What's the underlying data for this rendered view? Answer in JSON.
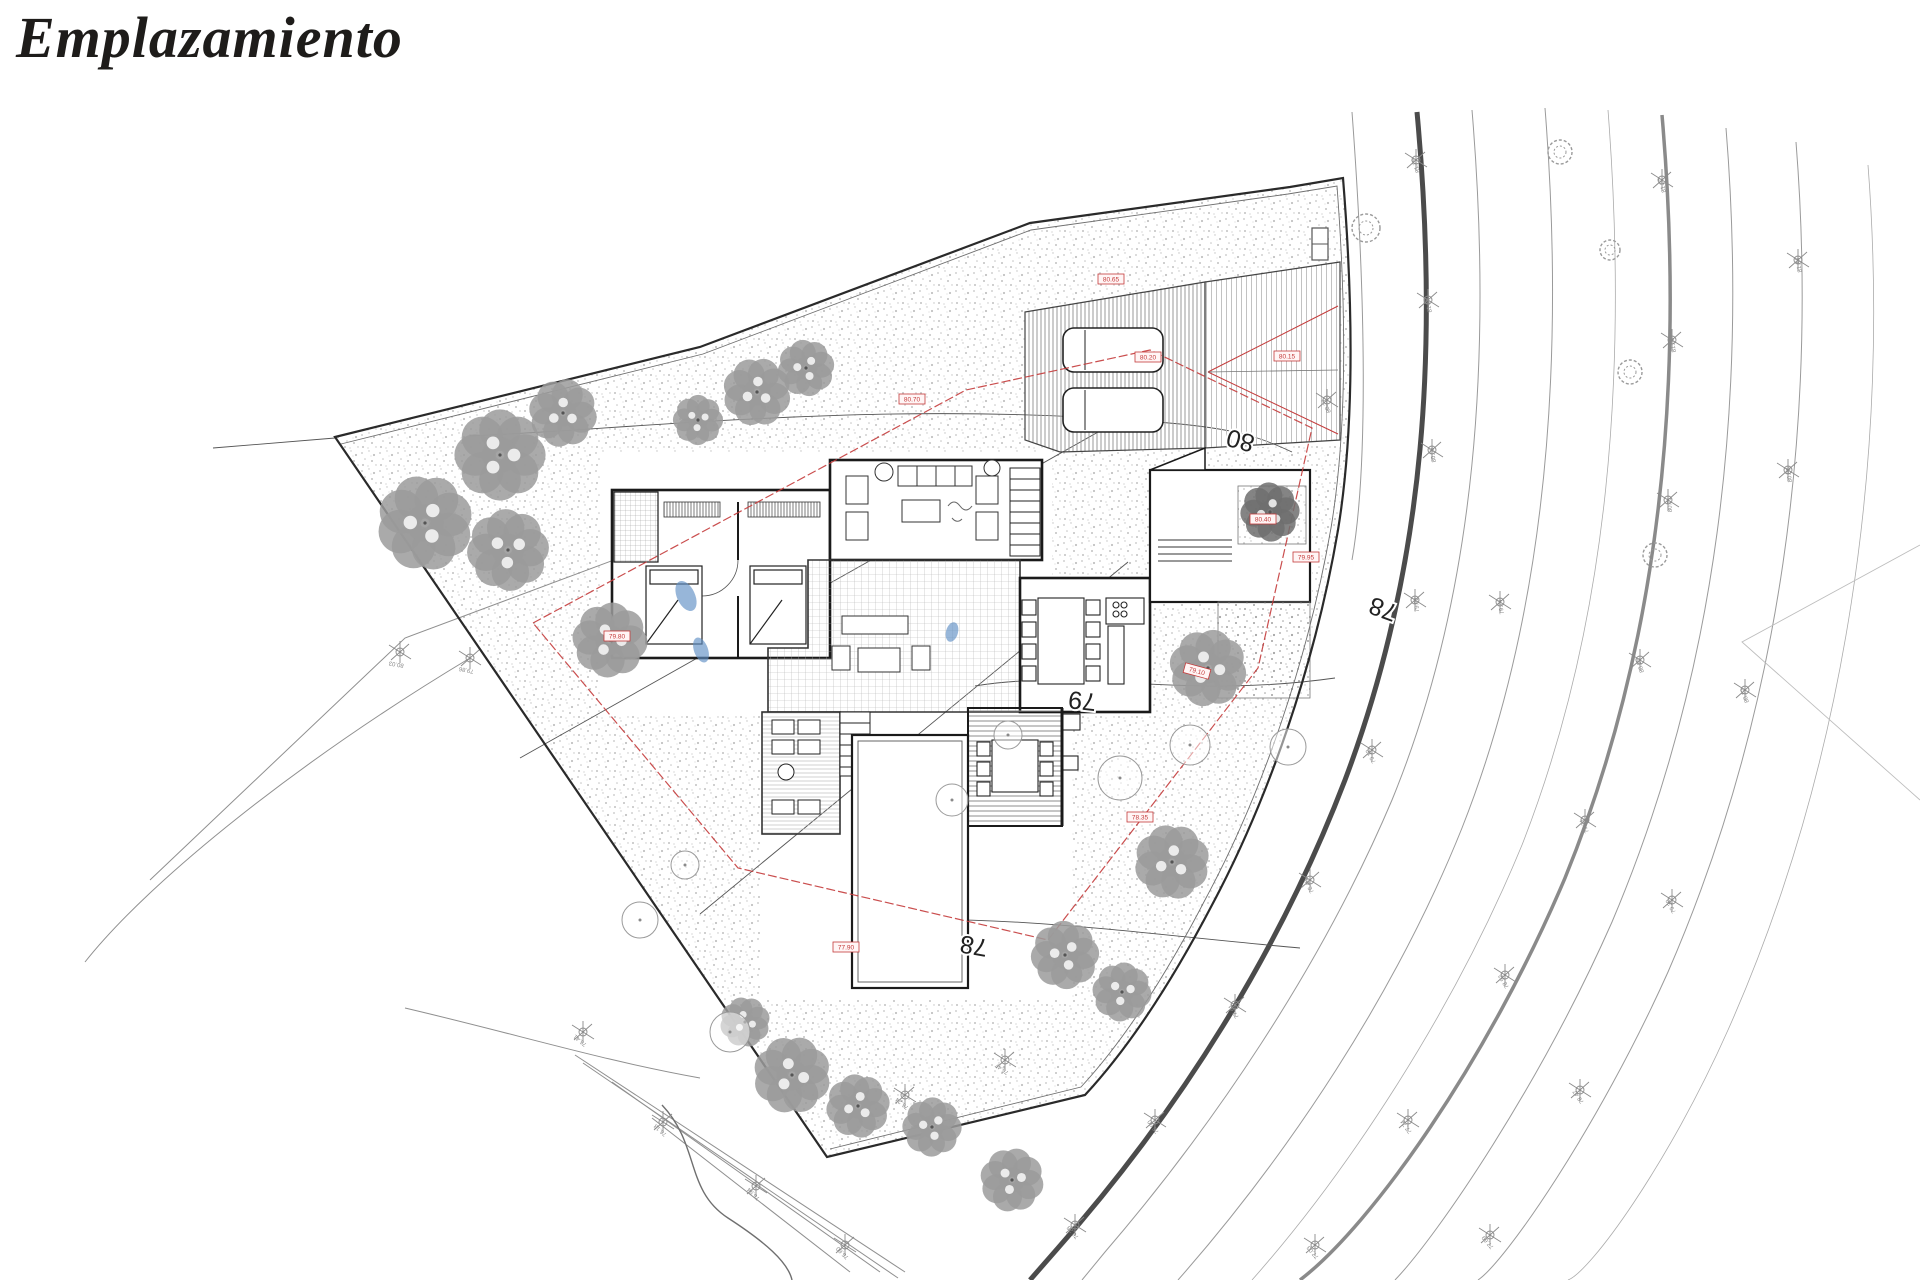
{
  "title": "Emplazamiento",
  "colors": {
    "wall": "#1a1a1a",
    "contour": "#555555",
    "road_thick": "#4b4b4b",
    "red": "#c43b3b",
    "tree": "#9b9b9b",
    "blue": "#5f8fc4"
  },
  "plan": {
    "contour_labels": [
      {
        "text": "80",
        "x": 1256,
        "y": 436,
        "rot": 195
      },
      {
        "text": "79",
        "x": 1097,
        "y": 694,
        "rot": 186
      },
      {
        "text": "78",
        "x": 989,
        "y": 940,
        "rot": 190
      },
      {
        "text": "78",
        "x": 1399,
        "y": 606,
        "rot": 200
      }
    ],
    "red_tags": [
      {
        "text": "80.70",
        "x": 912,
        "y": 399,
        "rot": 0
      },
      {
        "text": "80.65",
        "x": 1111,
        "y": 279,
        "rot": 0
      },
      {
        "text": "80.20",
        "x": 1148,
        "y": 357,
        "rot": 0
      },
      {
        "text": "80.15",
        "x": 1287,
        "y": 356,
        "rot": 0
      },
      {
        "text": "79.80",
        "x": 617,
        "y": 636,
        "rot": 0
      },
      {
        "text": "79.10",
        "x": 1197,
        "y": 671,
        "rot": 15
      },
      {
        "text": "78.35",
        "x": 1140,
        "y": 817,
        "rot": 0
      },
      {
        "text": "80.40",
        "x": 1263,
        "y": 519,
        "rot": 0
      },
      {
        "text": "79.95",
        "x": 1306,
        "y": 557,
        "rot": 0
      },
      {
        "text": "77.90",
        "x": 846,
        "y": 947,
        "rot": 0
      }
    ],
    "survey_markers": [
      {
        "x": 1416,
        "y": 160,
        "label": "81.76",
        "rot": 70
      },
      {
        "x": 1428,
        "y": 300,
        "label": "81.18",
        "rot": 75
      },
      {
        "x": 1432,
        "y": 450,
        "label": "80.56",
        "rot": 80
      },
      {
        "x": 1415,
        "y": 600,
        "label": "79.92",
        "rot": 85
      },
      {
        "x": 1372,
        "y": 750,
        "label": "79.12",
        "rot": 62
      },
      {
        "x": 1310,
        "y": 880,
        "label": "78.40",
        "rot": 64
      },
      {
        "x": 1235,
        "y": 1005,
        "label": "77.61",
        "rot": 60
      },
      {
        "x": 1155,
        "y": 1120,
        "label": "76.90",
        "rot": 55
      },
      {
        "x": 1075,
        "y": 1225,
        "label": "76.28",
        "rot": 50
      },
      {
        "x": 1662,
        "y": 180,
        "label": "81.92",
        "rot": 75
      },
      {
        "x": 1672,
        "y": 340,
        "label": "81.30",
        "rot": 80
      },
      {
        "x": 1668,
        "y": 500,
        "label": "80.71",
        "rot": 85
      },
      {
        "x": 1640,
        "y": 660,
        "label": "80.05",
        "rot": 72
      },
      {
        "x": 1585,
        "y": 820,
        "label": "79.31",
        "rot": 66
      },
      {
        "x": 1505,
        "y": 975,
        "label": "78.52",
        "rot": 60
      },
      {
        "x": 1408,
        "y": 1120,
        "label": "77.74",
        "rot": 55
      },
      {
        "x": 1315,
        "y": 1245,
        "label": "77.03",
        "rot": 50
      },
      {
        "x": 1798,
        "y": 260,
        "label": "81.44",
        "rot": 78
      },
      {
        "x": 1788,
        "y": 470,
        "label": "80.83",
        "rot": 82
      },
      {
        "x": 1745,
        "y": 690,
        "label": "80.12",
        "rot": 70
      },
      {
        "x": 1672,
        "y": 900,
        "label": "79.30",
        "rot": 62
      },
      {
        "x": 1580,
        "y": 1090,
        "label": "78.47",
        "rot": 56
      },
      {
        "x": 1490,
        "y": 1235,
        "label": "77.69",
        "rot": 50
      },
      {
        "x": 1327,
        "y": 400,
        "label": "80.22",
        "rot": 66
      },
      {
        "x": 1500,
        "y": 602,
        "label": "79.74",
        "rot": 80
      },
      {
        "x": 400,
        "y": 652,
        "label": "80.03",
        "rot": 10
      },
      {
        "x": 470,
        "y": 658,
        "label": "79.86",
        "rot": 12
      },
      {
        "x": 583,
        "y": 1032,
        "label": "76.41",
        "rot": 40
      },
      {
        "x": 663,
        "y": 1122,
        "label": "76.18",
        "rot": 42
      },
      {
        "x": 756,
        "y": 1186,
        "label": "75.94",
        "rot": 45
      },
      {
        "x": 905,
        "y": 1095,
        "label": "76.24",
        "rot": 40
      },
      {
        "x": 1005,
        "y": 1060,
        "label": "76.47",
        "rot": 36
      },
      {
        "x": 845,
        "y": 1245,
        "label": "75.60",
        "rot": 45
      }
    ],
    "trees_fluffy": [
      {
        "x": 500,
        "y": 455,
        "r": 40
      },
      {
        "x": 563,
        "y": 413,
        "r": 30
      },
      {
        "x": 425,
        "y": 523,
        "r": 42
      },
      {
        "x": 508,
        "y": 550,
        "r": 36
      },
      {
        "x": 610,
        "y": 640,
        "r": 33
      },
      {
        "x": 757,
        "y": 392,
        "r": 30
      },
      {
        "x": 806,
        "y": 368,
        "r": 25
      },
      {
        "x": 698,
        "y": 420,
        "r": 22
      },
      {
        "x": 1208,
        "y": 668,
        "r": 34
      },
      {
        "x": 1172,
        "y": 862,
        "r": 33
      },
      {
        "x": 1065,
        "y": 955,
        "r": 30
      },
      {
        "x": 1122,
        "y": 992,
        "r": 26
      },
      {
        "x": 792,
        "y": 1075,
        "r": 34
      },
      {
        "x": 858,
        "y": 1106,
        "r": 28
      },
      {
        "x": 932,
        "y": 1127,
        "r": 26
      },
      {
        "x": 1012,
        "y": 1180,
        "r": 28
      },
      {
        "x": 745,
        "y": 1022,
        "r": 22
      },
      {
        "x": 1270,
        "y": 512,
        "r": 26,
        "dark": true
      }
    ],
    "trees_outline": [
      {
        "x": 1190,
        "y": 745,
        "r": 20
      },
      {
        "x": 1288,
        "y": 747,
        "r": 18
      },
      {
        "x": 1120,
        "y": 778,
        "r": 22
      },
      {
        "x": 640,
        "y": 920,
        "r": 18
      },
      {
        "x": 730,
        "y": 1032,
        "r": 20
      },
      {
        "x": 685,
        "y": 865,
        "r": 14
      },
      {
        "x": 952,
        "y": 800,
        "r": 16
      },
      {
        "x": 1008,
        "y": 735,
        "r": 14
      }
    ],
    "trees_scribble": [
      {
        "x": 1366,
        "y": 228,
        "r": 14
      },
      {
        "x": 1560,
        "y": 152,
        "r": 12
      },
      {
        "x": 1630,
        "y": 372,
        "r": 12
      },
      {
        "x": 1655,
        "y": 555,
        "r": 12
      },
      {
        "x": 1610,
        "y": 250,
        "r": 10
      }
    ],
    "blue_marks": [
      {
        "x": 686,
        "y": 596,
        "rx": 9,
        "ry": 16,
        "rot": -25
      },
      {
        "x": 701,
        "y": 650,
        "rx": 7,
        "ry": 13,
        "rot": -20
      },
      {
        "x": 952,
        "y": 632,
        "rx": 6,
        "ry": 10,
        "rot": 15
      }
    ]
  }
}
